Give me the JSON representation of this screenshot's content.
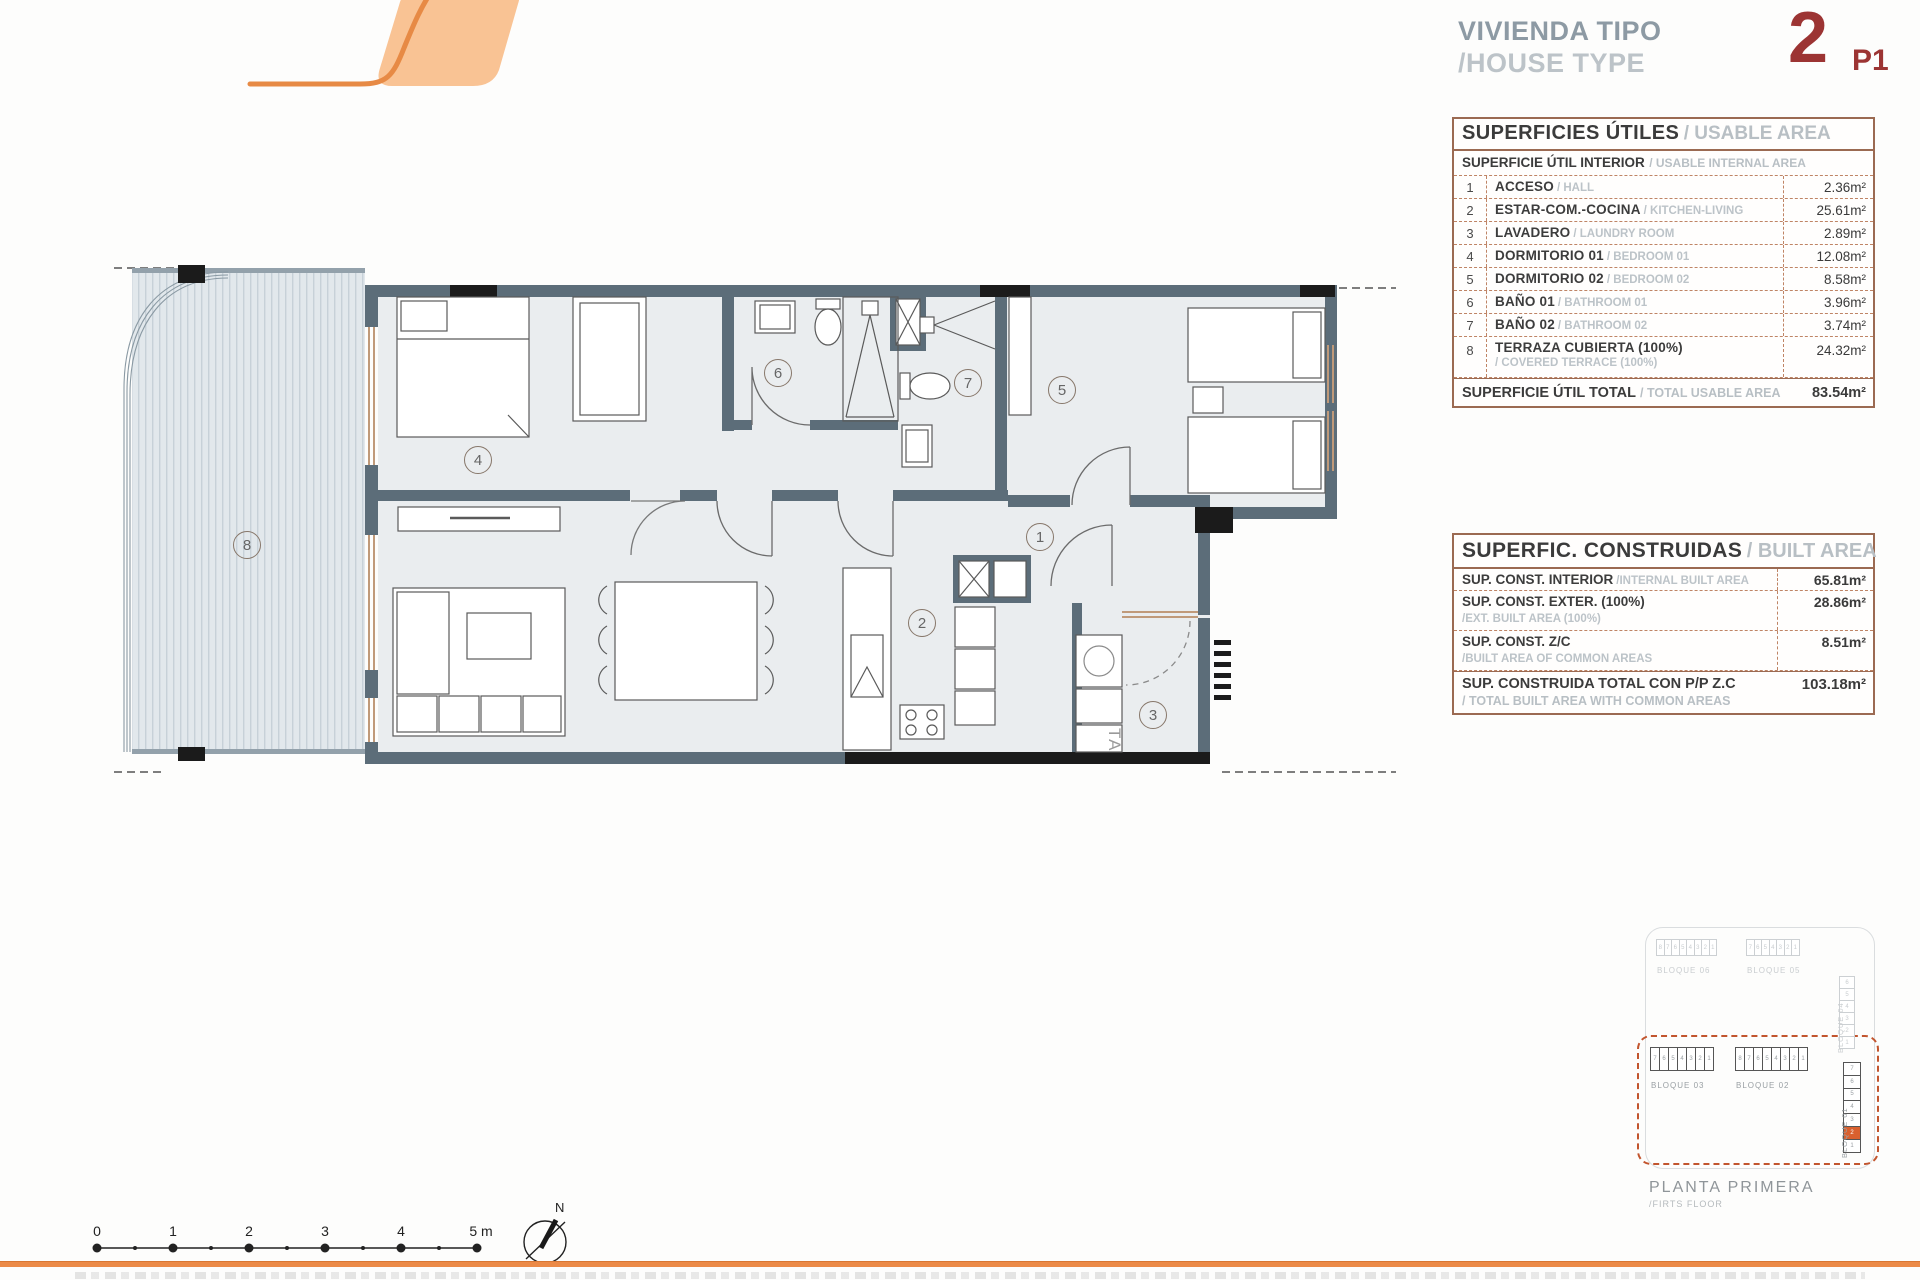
{
  "header": {
    "title_es": "VIVIENDA TIPO",
    "title_en": "/HOUSE TYPE",
    "type_number": "2",
    "type_floor": "P1"
  },
  "usable_table": {
    "title_es": "SUPERFICIES ÚTILES",
    "title_en": "/ USABLE AREA",
    "subtitle_es": "SUPERFICIE ÚTIL INTERIOR",
    "subtitle_en": "/ USABLE INTERNAL AREA",
    "rows": [
      {
        "num": "1",
        "es": "ACCESO",
        "en": "/ HALL",
        "value": "2.36m²"
      },
      {
        "num": "2",
        "es": "ESTAR-COM.-COCINA",
        "en": "/ KITCHEN-LIVING",
        "value": "25.61m²"
      },
      {
        "num": "3",
        "es": "LAVADERO",
        "en": "/ LAUNDRY ROOM",
        "value": "2.89m²"
      },
      {
        "num": "4",
        "es": "DORMITORIO 01",
        "en": "/ BEDROOM 01",
        "value": "12.08m²"
      },
      {
        "num": "5",
        "es": "DORMITORIO 02",
        "en": "/ BEDROOM 02",
        "value": "8.58m²"
      },
      {
        "num": "6",
        "es": "BAÑO 01",
        "en": "/ BATHROOM 01",
        "value": "3.96m²"
      },
      {
        "num": "7",
        "es": "BAÑO 02",
        "en": "/ BATHROOM 02",
        "value": "3.74m²"
      },
      {
        "num": "8",
        "es": "TERRAZA CUBIERTA (100%)",
        "en": "/ COVERED TERRACE (100%)",
        "value": "24.32m²",
        "two_line": true
      }
    ],
    "total_es": "SUPERFICIE ÚTIL TOTAL",
    "total_en": "/ TOTAL USABLE AREA",
    "total_value": "83.54m²"
  },
  "built_table": {
    "title_es": "SUPERFIC. CONSTRUIDAS",
    "title_en": "/ BUILT AREA",
    "rows": [
      {
        "es": "SUP. CONST. INTERIOR",
        "en": "/INTERNAL BUILT AREA",
        "value": "65.81m²",
        "inline": true
      },
      {
        "es": "SUP. CONST. EXTER. (100%)",
        "en": "/EXT. BUILT AREA (100%)",
        "value": "28.86m²"
      },
      {
        "es": "SUP. CONST. Z/C",
        "en": "/BUILT AREA OF COMMON AREAS",
        "value": "8.51m²"
      }
    ],
    "total_es": "SUP. CONSTRUIDA TOTAL CON P/P Z.C",
    "total_en": "/ TOTAL BUILT AREA WITH COMMON AREAS",
    "total_value": "103.18m²"
  },
  "plan": {
    "rooms": {
      "r1": "1",
      "r2": "2",
      "r3": "3",
      "r4": "4",
      "r5": "5",
      "r6": "6",
      "r7": "7",
      "r8": "8"
    },
    "washer_label": "TA"
  },
  "site_map": {
    "blocks_faded": [
      {
        "label": "BLOQUE 06",
        "units": [
          "8",
          "7",
          "6",
          "5",
          "4",
          "3",
          "2",
          "1"
        ],
        "orientation": "h"
      },
      {
        "label": "BLOQUE 05",
        "units": [
          "7",
          "6",
          "5",
          "4",
          "3",
          "2",
          "1"
        ],
        "orientation": "h"
      },
      {
        "label": "BLOQUE 04",
        "units": [
          "6",
          "5",
          "4",
          "3",
          "2",
          "1"
        ],
        "orientation": "v"
      }
    ],
    "blocks_active": [
      {
        "label": "BLOQUE 03",
        "units": [
          "7",
          "6",
          "5",
          "4",
          "3",
          "2",
          "1"
        ],
        "orientation": "h"
      },
      {
        "label": "BLOQUE 02",
        "units": [
          "8",
          "7",
          "6",
          "5",
          "4",
          "3",
          "2",
          "1"
        ],
        "orientation": "h"
      },
      {
        "label": "BLOQUE 01",
        "units": [
          "7",
          "6",
          "5",
          "4",
          "3",
          "2",
          "1"
        ],
        "orientation": "v",
        "highlight": "2"
      }
    ],
    "floor_es": "PLANTA PRIMERA",
    "floor_en": "/FIRTS FLOOR"
  },
  "scale_bar": {
    "labels": [
      "0",
      "1",
      "2",
      "3",
      "4",
      "5 m"
    ]
  },
  "north_label": "N",
  "colors": {
    "accent_orange": "#ec8a47",
    "logo_fill": "#f9c394",
    "type_red": "#9c3433",
    "wall": "#5c6d79",
    "table_border": "#9b6a52",
    "dashed_block": "#c2552e",
    "highlight_unit": "#d9602e"
  }
}
